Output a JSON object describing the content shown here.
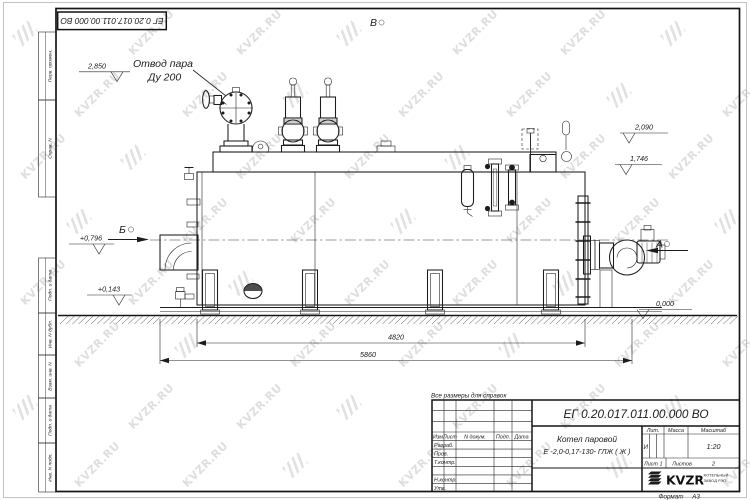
{
  "watermark": {
    "text": "KVZR.RU"
  },
  "frame": {
    "top_stamp": "ЕГ 0.20.017.011.00.000  ВО",
    "margin_labels": [
      "Перв. примен.",
      "Справ. N",
      "Подп. и дата",
      "Инв. N дубл.",
      "Взам. инв. N",
      "Подп. и дата",
      "Инв. N подл."
    ]
  },
  "note": "Все размеры для справок",
  "callout": {
    "line1": "Отвод пара",
    "line2": "Ду 200"
  },
  "elevations": {
    "steam": "2,850",
    "drum_top": "2,090",
    "rear_top": "1,746",
    "burner_axis": "+0,796",
    "front_low": "+0,143",
    "ground": "0,000"
  },
  "dimensions": {
    "boiler_length": "4820",
    "overall_length": "5860"
  },
  "views": {
    "a": "А",
    "b": "Б",
    "v": "В"
  },
  "title_block": {
    "designation": "ЕГ 0.20.017.011.00.000  ВО",
    "name_line1": "Котел паровой",
    "name_line2": "Е -2,0-0,17-130- ГЛЖ ( Ж )",
    "headers": {
      "lit": "Лит.",
      "mass": "Масса",
      "scale": "Масштаб"
    },
    "lit_value": "И",
    "scale_value": "1:20",
    "sheet_label": "Лист",
    "sheet_value": "1",
    "sheets_label": "Листов",
    "sheets_value": "2",
    "sig_headers": {
      "izm": "Изм",
      "list": "Лист",
      "doc": "N докум.",
      "sign": "Подп.",
      "date": "Дата"
    },
    "sig_rows": [
      "Разраб.",
      "Пров.",
      "Т.контр.",
      "Н.контр.",
      "Утв."
    ],
    "logo": {
      "name": "KVZR",
      "sub1": "КОТЕЛЬНЫЙ",
      "sub2": "ЗАВОД РЭП"
    },
    "format_label": "Формат",
    "format_value": "А3"
  }
}
